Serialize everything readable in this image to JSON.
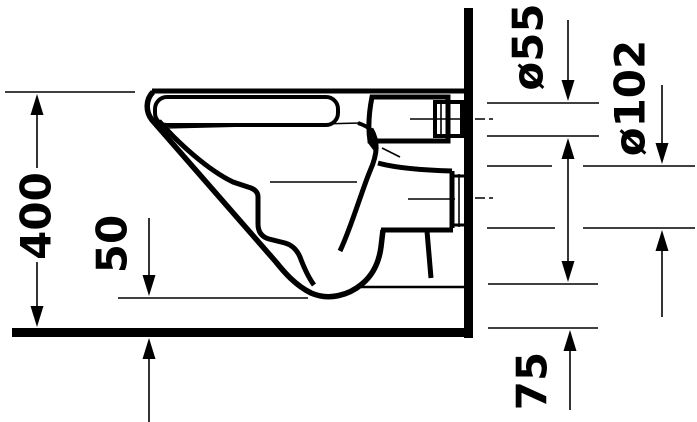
{
  "diagram": {
    "labels": {
      "overall_height": "400",
      "bowl_bottom_clearance": "50",
      "flush_inlet_diameter": "ø55",
      "outlet_diameter": "ø102",
      "outlet_bottom_height": "75"
    },
    "colors": {
      "line": "#000000",
      "background": "#ffffff"
    }
  }
}
